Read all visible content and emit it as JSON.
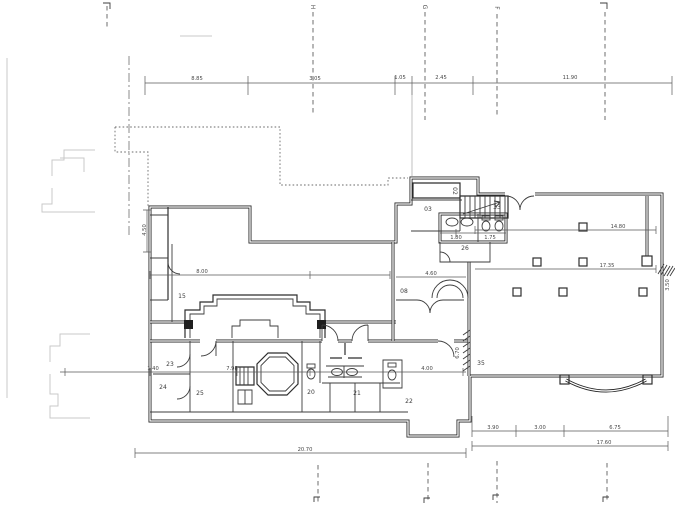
{
  "document_type": "scanned architectural floor plan",
  "colors": {
    "ink": "#2e2e2e",
    "paper": "#ffffff",
    "faint_artifact": "#c9c9c9"
  },
  "grid": {
    "top_letters": [
      {
        "label": "H"
      },
      {
        "label": "G"
      },
      {
        "label": "F"
      }
    ]
  },
  "rooms": {
    "r02": "02",
    "r03": "03",
    "r08": "08",
    "r15": "15",
    "r20": "20",
    "r21": "21",
    "r22": "22",
    "r23": "23",
    "r24": "24",
    "r25": "25",
    "r26": "26",
    "r33": "33",
    "r35": "35"
  },
  "dimensions": {
    "top": [
      "8.85",
      "3.05",
      "1.05",
      "2.45",
      "11.90"
    ],
    "interior": {
      "hall_upper": "14.80",
      "hall_lower": "17.35",
      "wc_left": "1.80",
      "wc_right": "1.75",
      "lounge": "8.00",
      "corridor_upper": "4.60",
      "corridor_lower": "4.00",
      "strip_small": "1.40",
      "strip_left": "7.98",
      "left_vertical": "4.50",
      "corridor_vertical": "6.70",
      "right_vertical": "3.50"
    },
    "bottom_left_total": "20.70",
    "bottom_right": [
      "3.90",
      "3.00",
      "6.75"
    ],
    "bottom_right_total": "17.60"
  }
}
